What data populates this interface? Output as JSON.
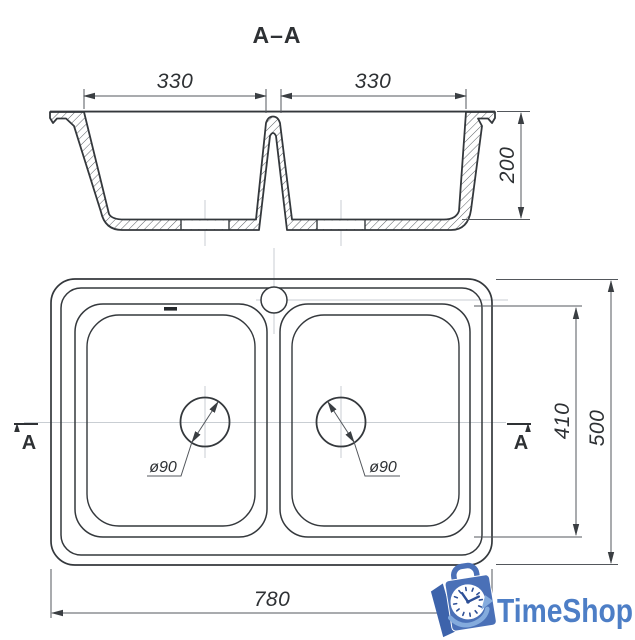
{
  "section": {
    "title": "A–A",
    "dim_bowl_left": "330",
    "dim_bowl_right": "330",
    "dim_depth": "200"
  },
  "plan": {
    "dim_bowls_length": "410",
    "dim_width": "500",
    "dim_length": "780",
    "drain_left": "ø90",
    "drain_right": "ø90",
    "marker_left": "A",
    "marker_right": "A"
  },
  "logo": {
    "text": "TimeShop",
    "brand_blue": "#4d7ec6",
    "bag_blue": "#4a70b7",
    "swoosh_blue": "#84abdd"
  }
}
